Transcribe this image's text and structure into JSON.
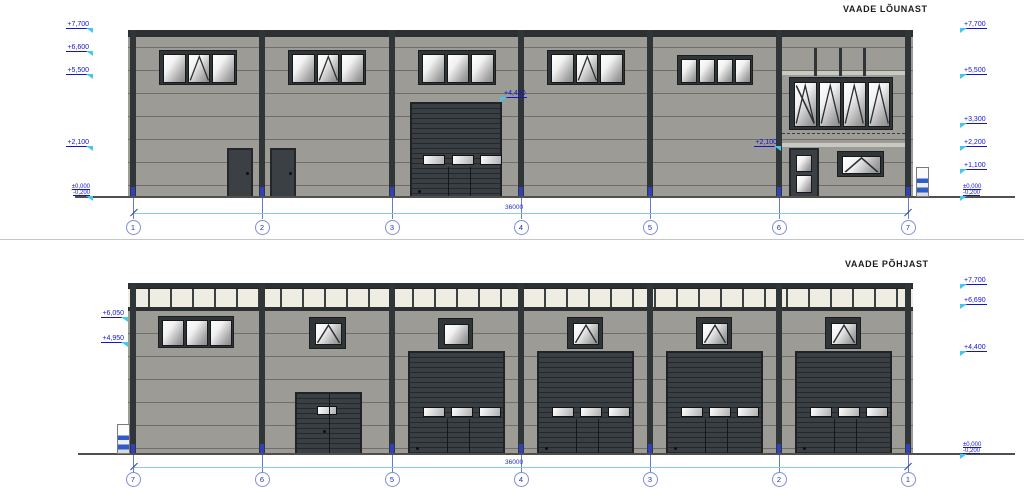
{
  "south": {
    "title": "VAADE LÕUNAST",
    "dim_total": "36000",
    "grid": [
      "1",
      "2",
      "3",
      "4",
      "5",
      "6",
      "7"
    ],
    "levels_left": [
      "+7,700",
      "+6,600",
      "+5,500",
      "+2,100"
    ],
    "levels_left_zero": [
      "±0,000",
      "-0,200"
    ],
    "levels_right": [
      "+7,700",
      "+5,500",
      "+3,300",
      "+2,200",
      "+1,100"
    ],
    "levels_right_zero": [
      "±0,000",
      "-0,200"
    ],
    "annotations": [
      "+4,400",
      "+2,100"
    ]
  },
  "north": {
    "title": "VAADE PÕHJAST",
    "dim_total": "36000",
    "grid": [
      "7",
      "6",
      "5",
      "4",
      "3",
      "2",
      "1"
    ],
    "levels_left": [
      "+6,050",
      "+4,950"
    ],
    "levels_right": [
      "+7,700",
      "+6,690",
      "+4,400"
    ],
    "levels_right_zero": [
      "±0,000",
      "-0,200"
    ]
  },
  "colors": {
    "wall_gray": "#9c9b96",
    "panel_joint": "#6f6f68",
    "frame_dark": "#303538",
    "clerestory_panel": "#efece1",
    "annotation_blue": "#1414cc",
    "flag_cyan": "#45c8ea",
    "dimension_cyan": "#86cdec",
    "grid_bubble_blue": "#7e8fd8",
    "bollard_blue": "#2d5bc8"
  }
}
